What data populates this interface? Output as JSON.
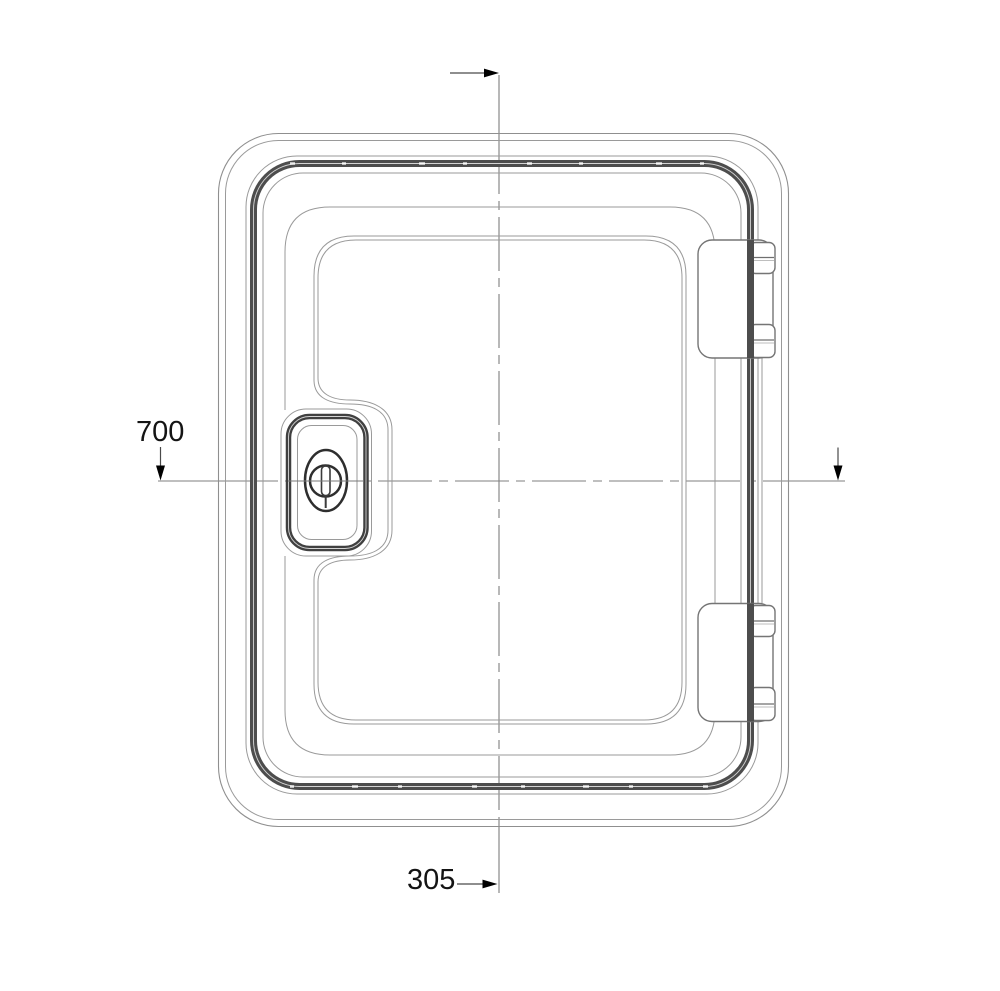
{
  "document": {
    "title": "Service door hatch - dimensioned front view technical drawing",
    "view": "front",
    "labels": {
      "dim_vertical": "700",
      "dim_horizontal": "305"
    },
    "colors": {
      "background": "#ffffff",
      "line_light": "#8f8f8f",
      "line_dark": "#4d4d4d",
      "centerline": "#7f7f7f",
      "text": "#141414",
      "arrow": "#000000"
    }
  }
}
